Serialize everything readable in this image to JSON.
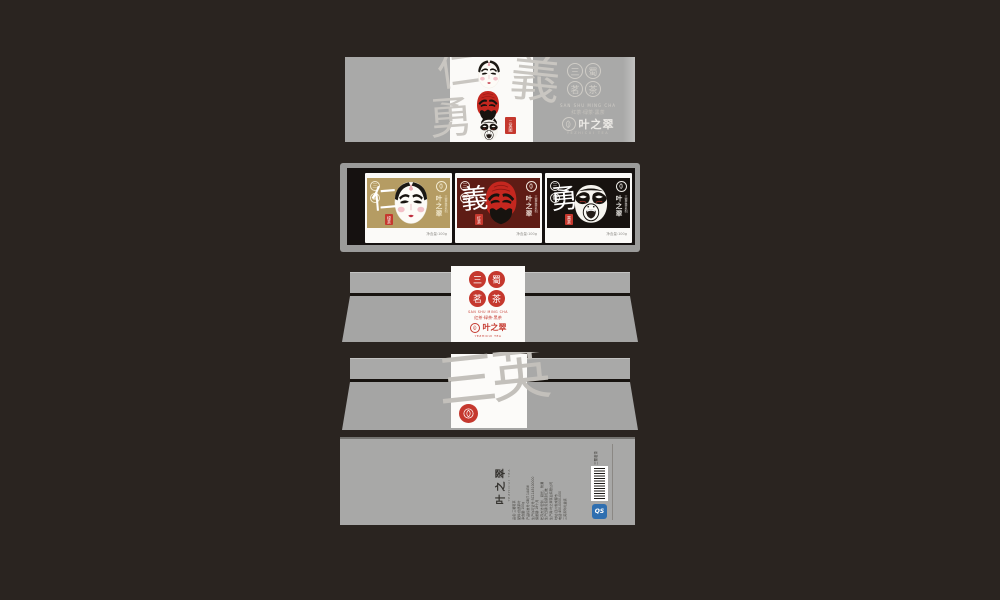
{
  "brand": {
    "name": "叶之翠",
    "name_en": "YEZHICUI TEA",
    "series_en": "SAN SHU MING CHA",
    "series_cn": "红茶·绿茶·黑茶",
    "series_seals": "三蜀茗茶",
    "series_title": "三蜀茗茶系列"
  },
  "watermarks": {
    "front_1": "仁",
    "front_2": "義",
    "front_3": "勇",
    "back": "三英"
  },
  "front_panel": {
    "side_seal": "三英图"
  },
  "cards": [
    {
      "virtue": "仁",
      "tea_seal": "绿茶",
      "mask": "white",
      "pair": "三蜀",
      "footer": "净含量:100g"
    },
    {
      "virtue": "義",
      "tea_seal": "红茶",
      "mask": "red",
      "pair": "三蜀",
      "footer": "净含量:100g"
    },
    {
      "virtue": "勇",
      "tea_seal": "黑茶",
      "mask": "black",
      "pair": "三蜀",
      "footer": "净含量:100g"
    }
  ],
  "back_info": {
    "top_label": "三蜀茗茶",
    "lines": [
      "品名:三蜀茗茶",
      "配料:优质茶叶",
      "净含量:100g",
      "产品标准号:GB/T 14456",
      "生产许可证号:SC1145100000",
      "保质期:18个月",
      "贮存方法:密封、避光、防潮",
      "生产日期:见包装封口处",
      "生产商:叶之翠茶业有限公司",
      "地址:四川省成都市",
      "电话:400-0000-000",
      "三英系列礼盒装"
    ],
    "qs_label": "QS"
  },
  "colors": {
    "seal_red": "#c5382e",
    "panel_gray": "#a9a9a8",
    "tray_black": "#151110",
    "card_gold": "#b59c63",
    "card_maroon": "#5e1c15",
    "card_black": "#17120f",
    "blue_mark": "#2f6fb0"
  }
}
